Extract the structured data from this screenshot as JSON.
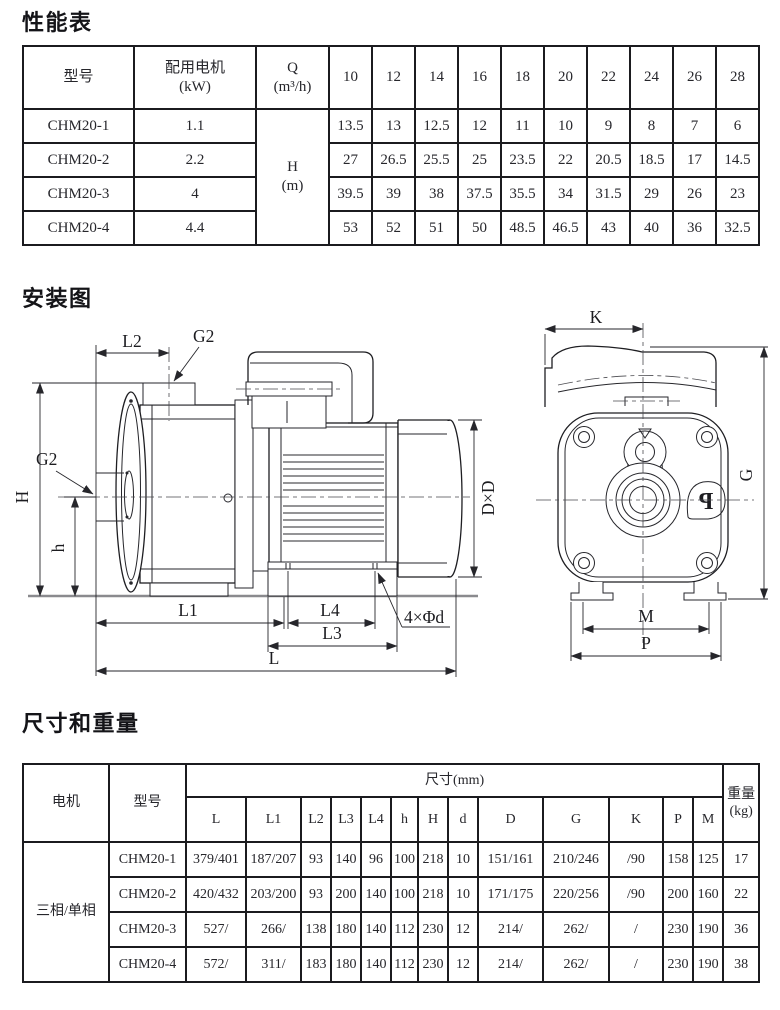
{
  "sections": {
    "performance": "性能表",
    "installation": "安装图",
    "dimensions": "尺寸和重量"
  },
  "performance_table": {
    "col_model": "型号",
    "col_motor_line1": "配用电机",
    "col_motor_line2": "(kW)",
    "q_label": "Q",
    "q_unit": "(m³/h)",
    "h_label": "H",
    "h_unit": "(m)",
    "flow_values": [
      "10",
      "12",
      "14",
      "16",
      "18",
      "20",
      "22",
      "24",
      "26",
      "28"
    ],
    "rows": [
      {
        "model": "CHM20-1",
        "power": "1.1",
        "heads": [
          "13.5",
          "13",
          "12.5",
          "12",
          "11",
          "10",
          "9",
          "8",
          "7",
          "6"
        ]
      },
      {
        "model": "CHM20-2",
        "power": "2.2",
        "heads": [
          "27",
          "26.5",
          "25.5",
          "25",
          "23.5",
          "22",
          "20.5",
          "18.5",
          "17",
          "14.5"
        ]
      },
      {
        "model": "CHM20-3",
        "power": "4",
        "heads": [
          "39.5",
          "39",
          "38",
          "37.5",
          "35.5",
          "34",
          "31.5",
          "29",
          "26",
          "23"
        ]
      },
      {
        "model": "CHM20-4",
        "power": "4.4",
        "heads": [
          "53",
          "52",
          "51",
          "50",
          "48.5",
          "46.5",
          "43",
          "40",
          "36",
          "32.5"
        ]
      }
    ]
  },
  "installation_diagram": {
    "labels": {
      "l2": "L2",
      "g2_top": "G2",
      "g2_left": "G2",
      "h_total": "H",
      "h_axis": "h",
      "dxd": "D×D",
      "l1": "L1",
      "l4": "L4",
      "l3": "L3",
      "l": "L",
      "bolt_holes": "4×Φd",
      "k": "K",
      "g": "G",
      "m": "M",
      "p": "P"
    },
    "logo_letter": "P"
  },
  "dimensions_table": {
    "col_motor": "电机",
    "col_model": "型号",
    "dims_header": "尺寸(mm)",
    "weight_line1": "重量",
    "weight_line2": "(kg)",
    "dim_cols": [
      "L",
      "L1",
      "L2",
      "L3",
      "L4",
      "h",
      "H",
      "d",
      "D",
      "G",
      "K",
      "P",
      "M"
    ],
    "motor_type": "三相/单相",
    "rows": [
      {
        "model": "CHM20-1",
        "values": [
          "379/401",
          "187/207",
          "93",
          "140",
          "96",
          "100",
          "218",
          "10",
          "151/161",
          "210/246",
          "/90",
          "158",
          "125"
        ],
        "weight": "17"
      },
      {
        "model": "CHM20-2",
        "values": [
          "420/432",
          "203/200",
          "93",
          "200",
          "140",
          "100",
          "218",
          "10",
          "171/175",
          "220/256",
          "/90",
          "200",
          "160"
        ],
        "weight": "22"
      },
      {
        "model": "CHM20-3",
        "values": [
          "527/",
          "266/",
          "138",
          "180",
          "140",
          "112",
          "230",
          "12",
          "214/",
          "262/",
          "/",
          "230",
          "190"
        ],
        "weight": "36"
      },
      {
        "model": "CHM20-4",
        "values": [
          "572/",
          "311/",
          "183",
          "180",
          "140",
          "112",
          "230",
          "12",
          "214/",
          "262/",
          "/",
          "230",
          "190"
        ],
        "weight": "38"
      }
    ]
  }
}
